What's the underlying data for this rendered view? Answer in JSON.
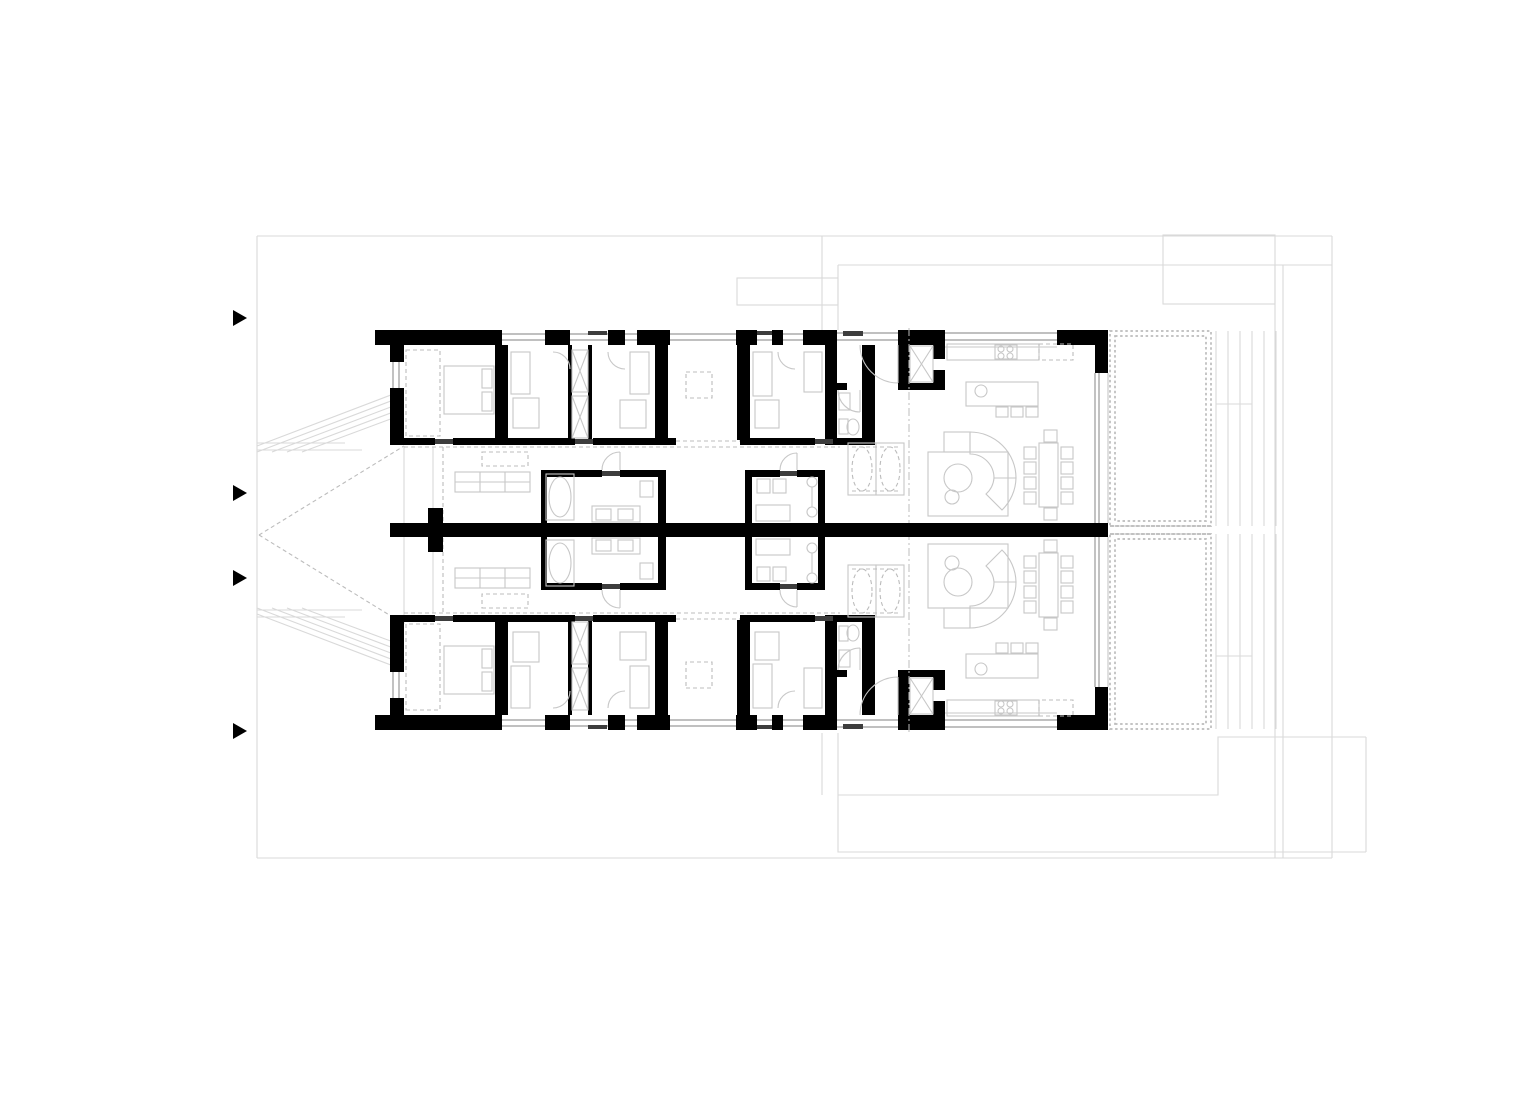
{
  "drawing": {
    "kind": "architectural-floor-plan",
    "units": 2,
    "mirrored_about_party_wall": true,
    "visible_text": ""
  },
  "colors": {
    "background": "#ffffff",
    "walls": "#000000",
    "furniture_lines": "#c7c7c7",
    "site_lines": "#d9d9d9",
    "dashed_lines": "#bcbcbc",
    "window_lines": "#9a9a9a",
    "threshold": "#3d3d3d",
    "marker": "#000000"
  },
  "icons": {
    "section_arrows": [
      {
        "x": 233,
        "y": 318
      },
      {
        "x": 233,
        "y": 493
      },
      {
        "x": 233,
        "y": 578
      },
      {
        "x": 233,
        "y": 731
      }
    ],
    "arrow_width": 14,
    "arrow_height": 16
  }
}
